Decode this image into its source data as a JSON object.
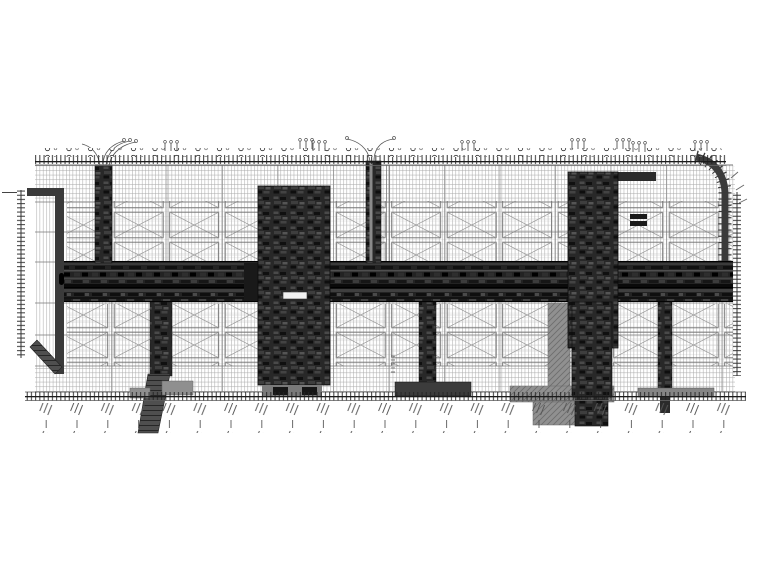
{
  "document": {
    "kind": "cad-engineering-plan",
    "subject": "underground-station-structural-plan",
    "legible_text": ""
  },
  "colors": {
    "paper": "#ffffff",
    "ink": "#1a1a1a",
    "grid_light": "#b0b0b0",
    "grid_mid": "#8d8d8d",
    "panel_stroke": "#6e6e6e",
    "corridor_dark": "#232323",
    "block_dark": "#282828",
    "ramp_gray": "#909090",
    "dim_tick": "#222222"
  },
  "parts": {
    "top_dimension_line": "row of dense ticks with grid bubbles",
    "bottom_dimension_line": "row of dense ticks with rotated annotation labels",
    "left_dimension_column": "vertical tick column",
    "right_dimension_column": "vertical tick column",
    "main_corridor": "dark horizontal station corridor band",
    "central_station_box": "large dark rectangular structure crossing corridor",
    "right_station_box": "large dark rectangular structure with curved site edge",
    "left_entrance_shaft": "vertical dark shaft with leader fan",
    "mid_riser": "vertical shaft above corridor with leader fan",
    "entrance_ramps": "gray hatched ramp structures at bottom",
    "xpanel_bands": "two bands of X-braced ceiling panels"
  }
}
